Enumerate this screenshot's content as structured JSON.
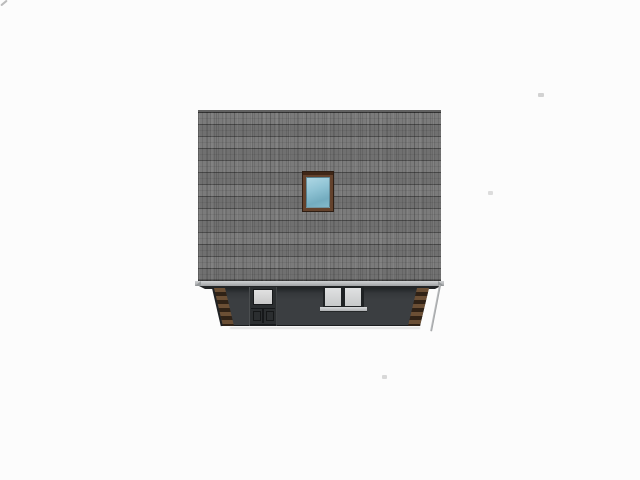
{
  "scene": {
    "description": "3D architectural elevation rendering of a house: large gray shingled roof slope with a centered skylight, light-gray eave fascia, and a dark lower wall in slight perspective containing an entry door with glass panel, a double window with sill, and brown stepped corner quoins on both slanted corners.",
    "view": "side elevation",
    "background": "#fcfcfc"
  },
  "colors": {
    "background": "#fcfcfc",
    "roof_base": "#767676",
    "roof_ridge": "#616161",
    "fascia_light": "#cfd1d3",
    "fascia_dark": "#a0a2a4",
    "soffit_shadow": "#232527",
    "wall": "#3b3e41",
    "wall_shadow": "#212426",
    "door": "#2b2e30",
    "door_glass": "#c8c8c8",
    "window_frame": "#1f2224",
    "window_pane": "#c7c9ca",
    "window_sill": "#aeb0b2",
    "skylight_frame": "#64422c",
    "skylight_glass": "#8fc3d4",
    "quoin_light": "#6b4f35",
    "quoin_dark": "#302216",
    "downspout": "#9a9c9e"
  },
  "parts": {
    "roof": {
      "label": "shingled roof slope"
    },
    "skylight": {
      "label": "skylight window with brown frame and blue glass"
    },
    "fascia": {
      "label": "eave fascia board"
    },
    "wall": {
      "label": "dark first-floor wall"
    },
    "door": {
      "label": "entry door with glass upper panel"
    },
    "window": {
      "label": "double casement window"
    },
    "sill": {
      "label": "window sill"
    },
    "quoins": {
      "label": "brick corner quoins"
    },
    "downspout": {
      "label": "corner downspout"
    }
  }
}
